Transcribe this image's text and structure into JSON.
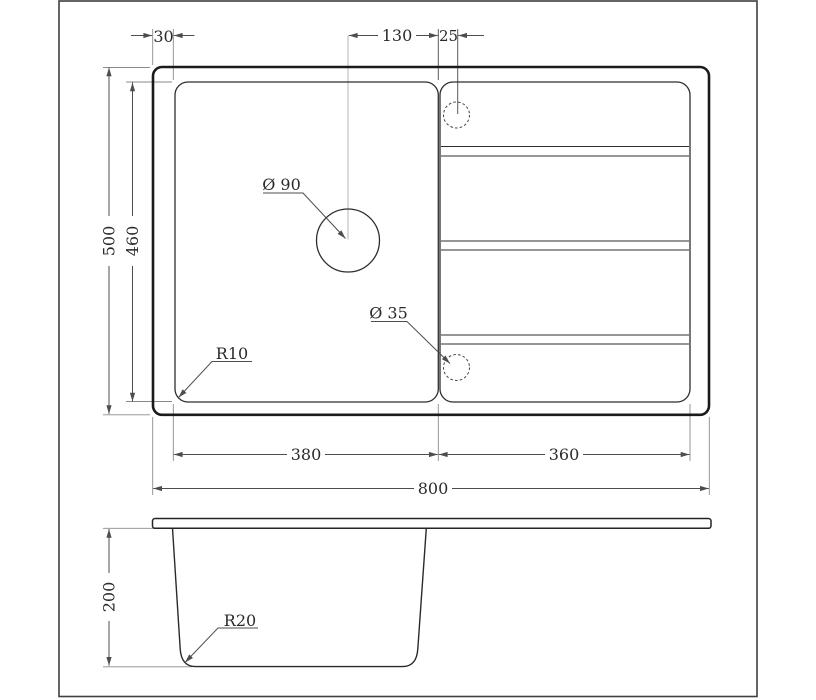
{
  "colors": {
    "background": "#ffffff",
    "outline_strong": "#1b1b1b",
    "outline_medium": "#2e2e2e",
    "dimension_line": "#4d4d4d",
    "extension_line": "#8a8a8a",
    "text": "#2b2b2b",
    "border": "#3f3f3f"
  },
  "top_view": {
    "dims": {
      "edge_to_bowl": "30",
      "hole_to_divider": "130",
      "divider_to_tap_hole": "25",
      "overall_front_to_back": "500",
      "bowl_front_to_back": "460",
      "bowl_width": "380",
      "drainboard_width": "360",
      "overall_width": "800"
    },
    "callouts": {
      "drain_hole_diameter": "Ø 90",
      "tap_hole_diameter": "Ø 35",
      "corner_radius": "R10"
    }
  },
  "side_view": {
    "dims": {
      "depth": "200"
    },
    "callouts": {
      "bottom_radius": "R20"
    }
  }
}
